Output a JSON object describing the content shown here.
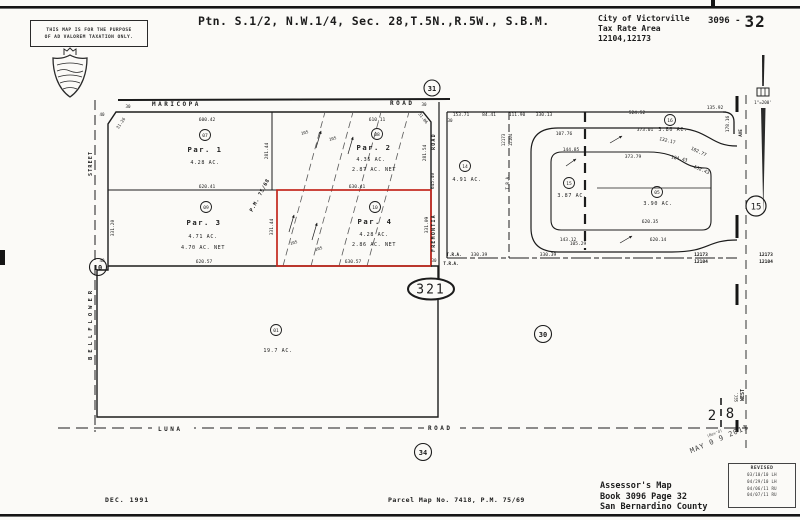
{
  "page": {
    "sheet_prefix": "3096 -",
    "sheet_number": "32"
  },
  "disclaimer": {
    "line1": "THIS MAP IS FOR THE PURPOSE",
    "line2": "OF AD VALOREM TAXATION ONLY."
  },
  "title": "Ptn. S.1/2, N.W.1/4, Sec. 28,T.5N.,R.5W., S.B.M.",
  "city_block": {
    "city": "City of Victorville",
    "label": "Tax Rate Area",
    "values": "12104,12173"
  },
  "scale_note": "1\"=200'",
  "roads": {
    "maricopa": "MARICOPA",
    "maricopa_suffix": "ROAD",
    "street": "STREET",
    "fremontia": "FREMONTIA",
    "fremontia_suffix": "ROAD",
    "luna": "LUNA",
    "luna_suffix": "ROAD",
    "bellflower": "BELLFLOWER",
    "right_road": "AVE"
  },
  "section": {
    "west": "WEST",
    "sec": "SEC.",
    "num_left": "2",
    "num_right": "8"
  },
  "parcels": {
    "p1": {
      "circle": "07",
      "name": "Par. 1",
      "area": "4.28 AC."
    },
    "p2": {
      "circle": "08",
      "name": "Par. 2",
      "area": "4.35 AC.",
      "net": "2.87 AC. NET"
    },
    "p3": {
      "circle": "09",
      "name": "Par. 3",
      "area": "4.71 AC.",
      "net": "4.70 AC. NET"
    },
    "p4": {
      "circle": "10",
      "name": "Par. 4",
      "area": "4.28 AC.",
      "net": "2.86 AC. NET"
    },
    "p01": {
      "circle": "01",
      "area": "19.7 AC."
    },
    "p14": {
      "circle": "14",
      "area": "4.91 AC."
    },
    "p16": {
      "circle": "16",
      "area": "3.80 AC."
    },
    "p15": {
      "circle": "15",
      "area": "3.87 AC."
    },
    "p05": {
      "circle": "05",
      "area": "3.90 AC."
    }
  },
  "refs": {
    "c31": "31",
    "c10": "10",
    "c34": "34",
    "c30": "30",
    "c15": "15",
    "hwy": "321"
  },
  "tra": {
    "label": "T.R.A.",
    "n1": "12173",
    "n2": "12104"
  },
  "dims": {
    "d600_42": "600.42",
    "d610_11": "610.11",
    "d620_41": "620.41",
    "d630_41": "630.41",
    "d620_57": "620.57",
    "d630_57": "630.57",
    "d281_44": "281.44",
    "d281_54": "281.54",
    "d331_20": "331.20",
    "d331_44": "331.44",
    "d331_09": "331.09",
    "d645_40": "645.40",
    "d31_26": "31.26",
    "d31_06": "31.06",
    "d105": "105",
    "pm": "P.M. 75/68",
    "d153_71": "153.71",
    "d84_41": "84.41",
    "d111_90": "111.90",
    "d330_13": "330.13",
    "d524_52": "524.52",
    "d135_92": "135.92",
    "d178_16": "178.16",
    "d107_76": "107.76",
    "d373_01": "373.01",
    "d132_17": "132.17",
    "d102_77": "102.77",
    "d144_85": "144.85",
    "d373_79": "373.79",
    "d124_43": "124.43",
    "d132_43": "132.43",
    "d143_12": "143.12",
    "d620_35": "620.35",
    "d105_29": "105.29",
    "d620_14": "620.14",
    "d330_39": "330.39",
    "d40": "40",
    "d30": "30"
  },
  "footer": {
    "date": "DEC. 1991",
    "reference": "Parcel Map No. 7418, P.M. 75/69",
    "assessor1": "Assessor's Map",
    "assessor2": "Book 3096 Page 32",
    "assessor3": "San Bernardino County"
  },
  "revised": {
    "title": "REVISED",
    "entries": [
      "03/10/10 LH",
      "04/29/10 LH",
      "04/06/11 RU",
      "04/07/11 RU"
    ]
  },
  "stamp": {
    "rev": "(Rev'd)",
    "date": "MAY 0 9 2011"
  }
}
